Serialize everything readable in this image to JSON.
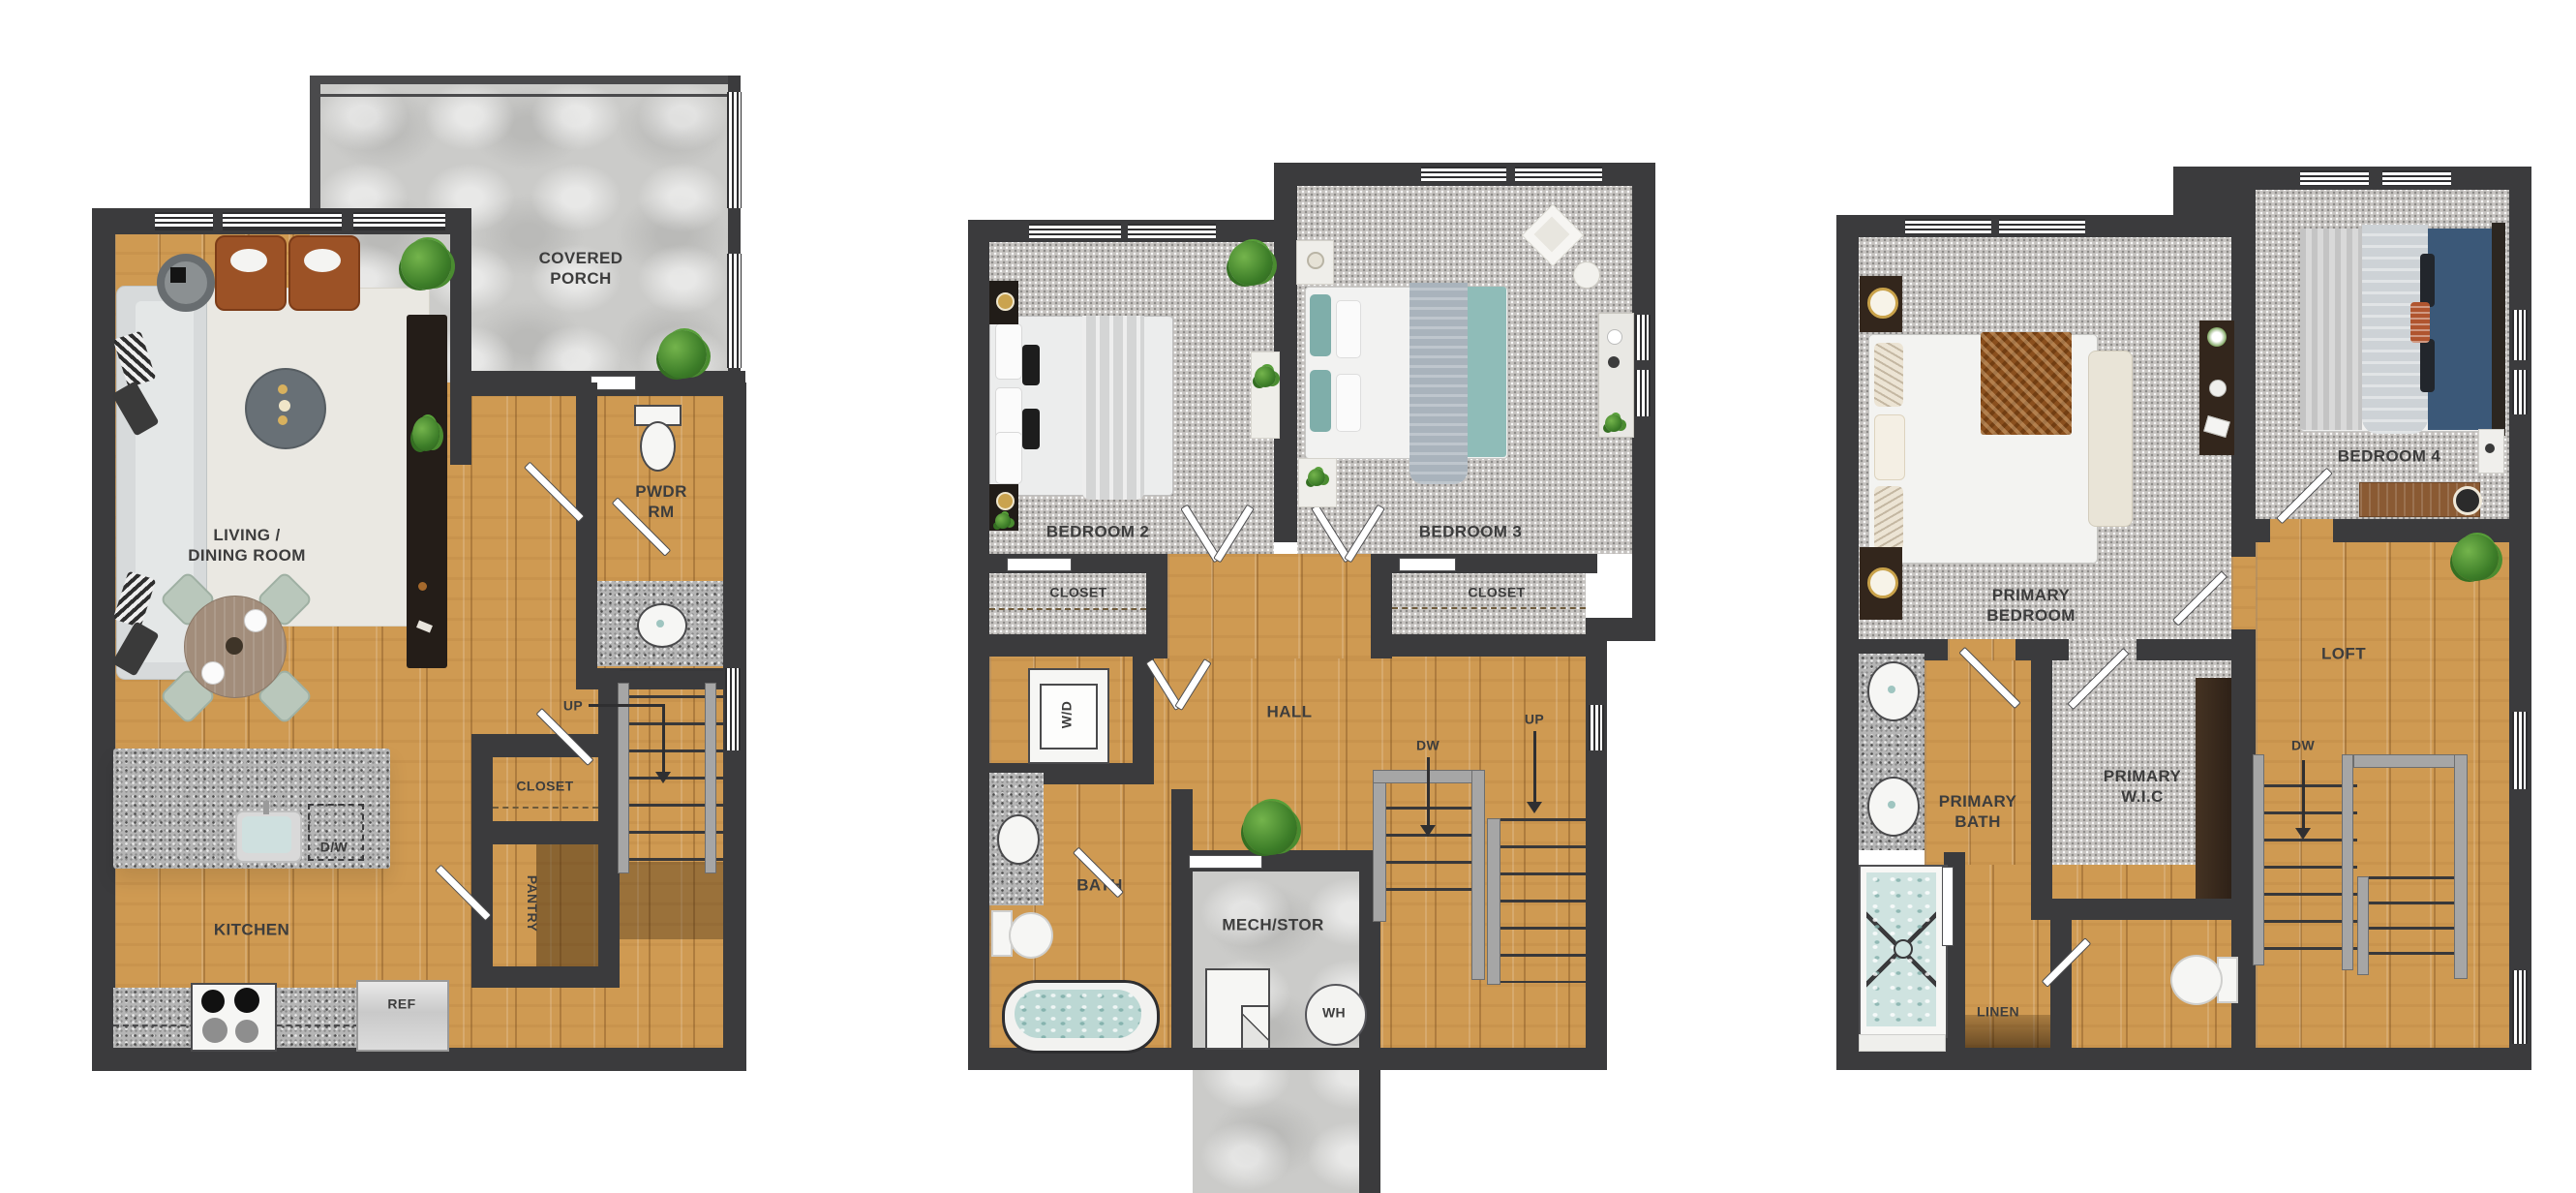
{
  "colors": {
    "wall": "#3b3b3d",
    "wood_floor": "#cf9a52",
    "carpet": "#c6c3c0",
    "porch_concrete": "#cbcbc9",
    "granite": "#b5b5b5",
    "label_text": "#3d3d3d",
    "teal_bedding": "#8fbcb8",
    "navy_bedding": "#3b5878",
    "leather_chair": "#9c5226",
    "plant_green": "#3c7d28"
  },
  "plan1": {
    "covered_porch": "COVERED\nPORCH",
    "pwdr_rm": "PWDR\nRM",
    "living_dining": "LIVING /\nDINING ROOM",
    "up": "UP",
    "closet": "CLOSET",
    "pantry": "PANTRY",
    "kitchen": "KITCHEN",
    "ref": "REF",
    "dw": "D/W"
  },
  "plan2": {
    "bedroom2": "BEDROOM 2",
    "bedroom3": "BEDROOM 3",
    "closet2": "CLOSET",
    "closet3": "CLOSET",
    "hall": "HALL",
    "wd": "W/D",
    "dw": "DW",
    "up": "UP",
    "bath": "BATH",
    "mech_stor": "MECH/STOR",
    "wh": "WH"
  },
  "plan3": {
    "primary_bedroom": "PRIMARY\nBEDROOM",
    "bedroom4": "BEDROOM 4",
    "loft": "LOFT",
    "primary_bath": "PRIMARY\nBATH",
    "primary_wic": "PRIMARY\nW.I.C",
    "dw": "DW",
    "linen": "LINEN"
  }
}
